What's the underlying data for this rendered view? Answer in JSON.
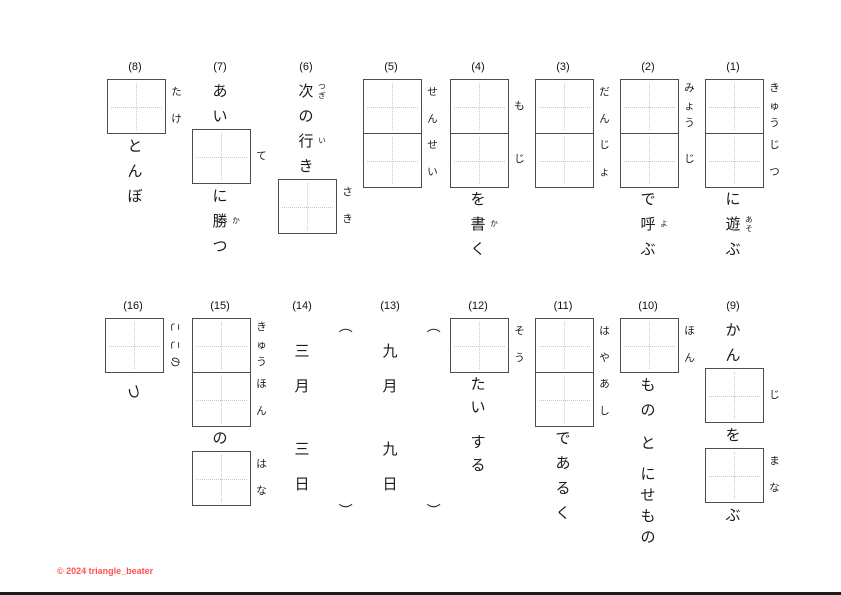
{
  "footer": {
    "text": "© 2024 triangle_beater",
    "color": "#ff5252"
  },
  "paren_open": "（",
  "paren_close": "）",
  "accent_colors": {
    "box_border": "#4d4d4d",
    "guide_dots": "#c9c9c9",
    "text": "#1a1a1a"
  },
  "problems": [
    {
      "label": "(1)",
      "items": [
        {
          "type": "boxes",
          "furigana": [
            "きゅう",
            "じつ"
          ]
        },
        {
          "type": "text",
          "chars": [
            {
              "c": "に"
            },
            {
              "c": "遊",
              "ruby": "あそ"
            },
            {
              "c": "ぶ"
            }
          ]
        }
      ]
    },
    {
      "label": "(2)",
      "items": [
        {
          "type": "boxes",
          "furigana": [
            "みょう",
            "じ"
          ]
        },
        {
          "type": "text",
          "chars": [
            {
              "c": "で"
            },
            {
              "c": "呼",
              "ruby": "よ"
            },
            {
              "c": "ぶ"
            }
          ]
        }
      ]
    },
    {
      "label": "(3)",
      "items": [
        {
          "type": "boxes",
          "furigana": [
            "だん",
            "じょ"
          ]
        }
      ]
    },
    {
      "label": "(4)",
      "items": [
        {
          "type": "boxes",
          "furigana": [
            "も",
            "じ"
          ]
        },
        {
          "type": "text",
          "chars": [
            {
              "c": "を"
            },
            {
              "c": "書",
              "ruby": "か"
            },
            {
              "c": "く"
            }
          ]
        }
      ]
    },
    {
      "label": "(5)",
      "items": [
        {
          "type": "boxes",
          "furigana": [
            "せん",
            "せい"
          ]
        }
      ]
    },
    {
      "label": "(6)",
      "items": [
        {
          "type": "text",
          "chars": [
            {
              "c": "次",
              "ruby": "つぎ"
            },
            {
              "c": "の"
            },
            {
              "c": "行",
              "ruby": "い"
            },
            {
              "c": "き"
            }
          ]
        },
        {
          "type": "boxes",
          "furigana": [
            "さき"
          ]
        }
      ]
    },
    {
      "label": "(7)",
      "items": [
        {
          "type": "text",
          "chars": [
            {
              "c": "あ"
            },
            {
              "c": "い"
            }
          ]
        },
        {
          "type": "boxes",
          "furigana": [
            "て"
          ]
        },
        {
          "type": "text",
          "chars": [
            {
              "c": "に"
            },
            {
              "c": "勝",
              "ruby": "か"
            },
            {
              "c": "つ"
            }
          ]
        }
      ]
    },
    {
      "label": "(8)",
      "items": [
        {
          "type": "boxes",
          "furigana": [
            "たけ"
          ]
        },
        {
          "type": "text",
          "chars": [
            {
              "c": "と"
            },
            {
              "c": "ん"
            },
            {
              "c": "ぼ"
            }
          ]
        }
      ]
    },
    {
      "label": "(9)",
      "items": [
        {
          "type": "text",
          "chars": [
            {
              "c": "か"
            },
            {
              "c": "ん"
            }
          ]
        },
        {
          "type": "boxes",
          "furigana": [
            "じ"
          ]
        },
        {
          "type": "text",
          "chars": [
            {
              "c": "を"
            }
          ]
        },
        {
          "type": "boxes",
          "furigana": [
            "まな"
          ]
        },
        {
          "type": "text",
          "chars": [
            {
              "c": "ぶ"
            }
          ]
        }
      ]
    },
    {
      "label": "(10)",
      "items": [
        {
          "type": "boxes",
          "furigana": [
            "ほん"
          ]
        },
        {
          "type": "text",
          "chars": [
            {
              "c": "も"
            },
            {
              "c": "の"
            }
          ]
        },
        {
          "type": "gap",
          "h": 8
        },
        {
          "type": "text",
          "chars": [
            {
              "c": "と"
            }
          ]
        },
        {
          "type": "gap",
          "h": 8
        },
        {
          "type": "text",
          "cell": 21,
          "chars": [
            {
              "c": "に"
            },
            {
              "c": "せ"
            },
            {
              "c": "も"
            },
            {
              "c": "の"
            }
          ]
        }
      ]
    },
    {
      "label": "(11)",
      "items": [
        {
          "type": "boxes",
          "furigana": [
            "はや",
            "あし"
          ]
        },
        {
          "type": "text",
          "chars": [
            {
              "c": "で"
            },
            {
              "c": "あ"
            },
            {
              "c": "る"
            },
            {
              "c": "く"
            }
          ]
        }
      ]
    },
    {
      "label": "(12)",
      "items": [
        {
          "type": "boxes",
          "furigana": [
            "そう"
          ]
        },
        {
          "type": "text",
          "cell": 23,
          "chars": [
            {
              "c": "た"
            },
            {
              "c": "い"
            }
          ]
        },
        {
          "type": "gap",
          "h": 12
        },
        {
          "type": "text",
          "cell": 23,
          "chars": [
            {
              "c": "す"
            },
            {
              "c": "る"
            }
          ]
        }
      ]
    },
    {
      "label": "(13)",
      "items": [
        {
          "type": "paren",
          "side": "open"
        },
        {
          "type": "text",
          "cell": 35,
          "chars": [
            {
              "c": "九"
            },
            {
              "c": "月"
            }
          ]
        },
        {
          "type": "gap",
          "h": 28
        },
        {
          "type": "text",
          "cell": 35,
          "chars": [
            {
              "c": "九"
            },
            {
              "c": "日"
            }
          ]
        },
        {
          "type": "paren",
          "side": "close"
        }
      ]
    },
    {
      "label": "(14)",
      "items": [
        {
          "type": "paren",
          "side": "open"
        },
        {
          "type": "text",
          "cell": 35,
          "chars": [
            {
              "c": "三"
            },
            {
              "c": "月"
            }
          ]
        },
        {
          "type": "gap",
          "h": 28
        },
        {
          "type": "text",
          "cell": 35,
          "chars": [
            {
              "c": "三"
            },
            {
              "c": "日"
            }
          ]
        },
        {
          "type": "paren",
          "side": "close"
        }
      ]
    },
    {
      "label": "(15)",
      "items": [
        {
          "type": "boxes",
          "furigana": [
            "きゅう",
            "ほん"
          ]
        },
        {
          "type": "text",
          "chars": [
            {
              "c": "の"
            }
          ]
        },
        {
          "type": "boxes",
          "furigana": [
            "はな"
          ]
        }
      ]
    },
    {
      "label": "(16)",
      "items": [
        {
          "type": "boxes",
          "furigana": [
            "ここの"
          ],
          "rotated": true
        },
        {
          "type": "gap",
          "h": 6
        },
        {
          "type": "text",
          "rotated": true,
          "chars": [
            {
              "c": "つ"
            }
          ]
        }
      ]
    }
  ]
}
